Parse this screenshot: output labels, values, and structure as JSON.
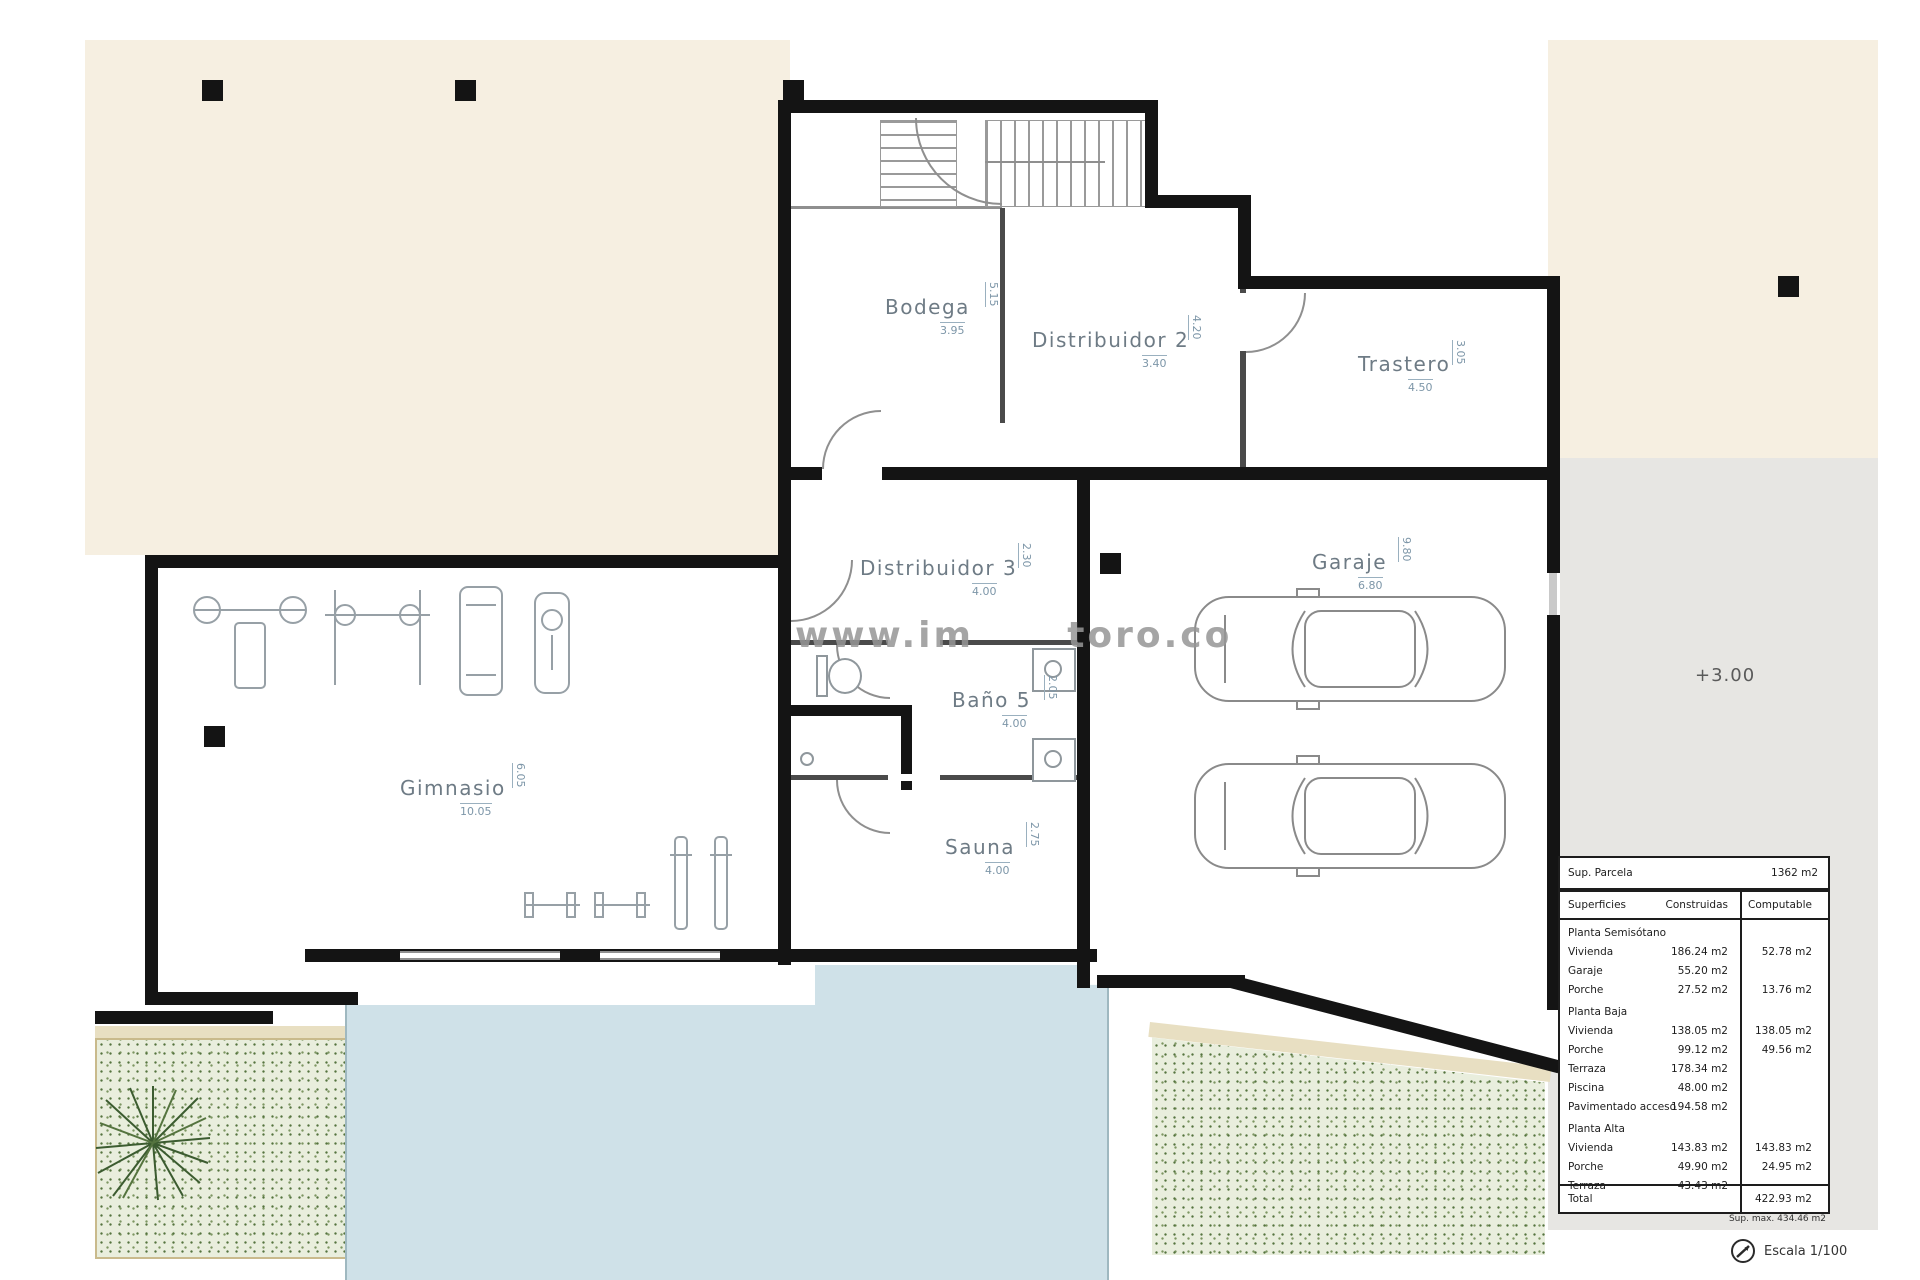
{
  "plan": {
    "watermark": "www.im      toro.co",
    "level_marker": "+3.00",
    "rooms": [
      {
        "name": "Bodega",
        "w": "3.95",
        "h": "5.15"
      },
      {
        "name": "Distribuidor  2",
        "w": "3.40",
        "h": "4.20"
      },
      {
        "name": "Trastero",
        "w": "4.50",
        "h": "3.05"
      },
      {
        "name": "Distribuidor  3",
        "w": "4.00",
        "h": "2.30"
      },
      {
        "name": "Baño  5",
        "w": "4.00",
        "h": "2.05"
      },
      {
        "name": "Sauna",
        "w": "4.00",
        "h": "2.75"
      },
      {
        "name": "Gimnasio",
        "w": "10.05",
        "h": "6.05"
      },
      {
        "name": "Garaje",
        "w": "6.80",
        "h": "9.80"
      }
    ]
  },
  "table": {
    "parcela_label": "Sup. Parcela",
    "parcela_value": "1362 m2",
    "headers": {
      "label": "Superficies",
      "col1": "Construidas",
      "col2": "Computable"
    },
    "sections": [
      {
        "title": "Planta Semisótano",
        "rows": [
          {
            "label": "Vivienda",
            "construidas": "186.24 m2",
            "computable": "52.78 m2"
          },
          {
            "label": "Garaje",
            "construidas": "55.20 m2",
            "computable": ""
          },
          {
            "label": "Porche",
            "construidas": "27.52 m2",
            "computable": "13.76 m2"
          }
        ]
      },
      {
        "title": "Planta Baja",
        "rows": [
          {
            "label": "Vivienda",
            "construidas": "138.05 m2",
            "computable": "138.05 m2"
          },
          {
            "label": "Porche",
            "construidas": "99.12 m2",
            "computable": "49.56 m2"
          },
          {
            "label": "Terraza",
            "construidas": "178.34 m2",
            "computable": ""
          },
          {
            "label": "Piscina",
            "construidas": "48.00 m2",
            "computable": ""
          },
          {
            "label": "Pavimentado acceso",
            "construidas": "194.58 m2",
            "computable": ""
          }
        ]
      },
      {
        "title": "Planta Alta",
        "rows": [
          {
            "label": "Vivienda",
            "construidas": "143.83 m2",
            "computable": "143.83 m2"
          },
          {
            "label": "Porche",
            "construidas": "49.90 m2",
            "computable": "24.95 m2"
          },
          {
            "label": "Terraza",
            "construidas": "43.43 m2",
            "computable": ""
          }
        ]
      }
    ],
    "total_label": "Total",
    "total_value": "422.93 m2",
    "footnote": "Sup. max. 434.46 m2"
  },
  "footer": {
    "scale_label": "Escala 1/100"
  }
}
